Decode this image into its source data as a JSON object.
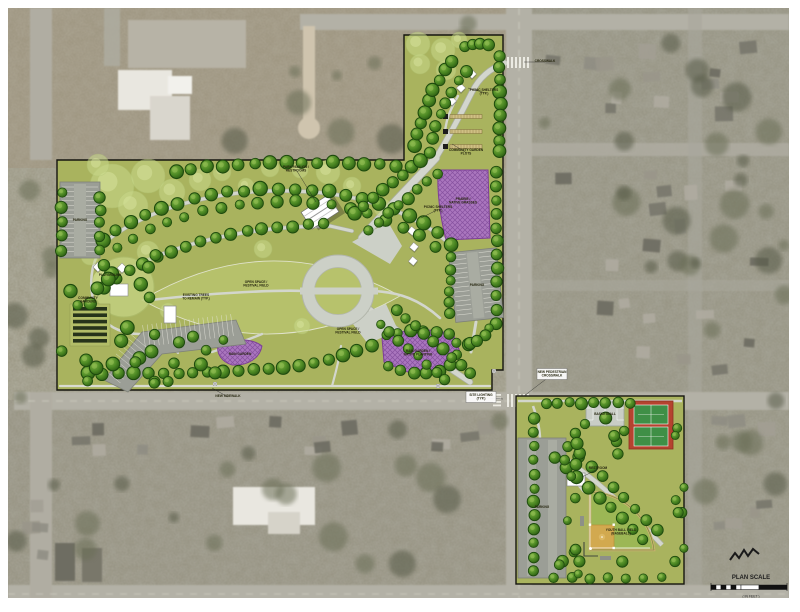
{
  "plan": {
    "title": "Park Master Plan Rendering",
    "scale": {
      "title": "PLAN SCALE",
      "units": "( IN FEET )",
      "note": "1 INCH = 100 FT."
    },
    "colors": {
      "plan_green": "#a9b35e",
      "lawn_green": "#b7c26c",
      "tree_green": "#3f7d21",
      "native_purple": "#a873bd",
      "tennis_red": "#b5432f",
      "court_green": "#3f8f46",
      "infield_tan": "#d2a94f",
      "path_gray": "#d3d6cd"
    },
    "annotations": [
      {
        "text": "PARK PAVILION /\nRESTROOMS",
        "x": 296,
        "y": 168,
        "lx": 316,
        "ly": 202
      },
      {
        "text": "OPEN SPACE /\nFESTIVAL FIELD",
        "x": 256,
        "y": 283
      },
      {
        "text": "OPEN SPACE /\nFESTIVAL FIELD",
        "x": 348,
        "y": 330
      },
      {
        "text": "PICNIC SHELTERS\n(TYP.)",
        "x": 438,
        "y": 208,
        "lx": 421,
        "ly": 218
      },
      {
        "text": "PLAYGROUND",
        "x": 110,
        "y": 276
      },
      {
        "text": "COMMUNITY\nGARDENS",
        "x": 88,
        "y": 299
      },
      {
        "text": "EXISTING TREES\nTO REMAIN (TYP.)",
        "x": 196,
        "y": 296
      },
      {
        "text": "RAIN GARDEN /\nNATIVE PLANTING",
        "x": 418,
        "y": 352
      },
      {
        "text": "RAIN GARDEN",
        "x": 240,
        "y": 355
      },
      {
        "text": "PRAIRIE /\nNATIVE GRASSES",
        "x": 463,
        "y": 200
      },
      {
        "text": "COMMUNITY GARDEN\nPLOTS",
        "x": 466,
        "y": 151,
        "lx": 452,
        "ly": 144
      },
      {
        "text": "PICNIC SHELTERS\n(TYP.)",
        "x": 484,
        "y": 91,
        "lx": 468,
        "ly": 88
      },
      {
        "text": "CROSSWALK",
        "x": 545,
        "y": 62,
        "lx": 524,
        "ly": 62
      },
      {
        "text": "NEW SIDEWALK",
        "x": 228,
        "y": 397,
        "lx": 212,
        "ly": 388
      },
      {
        "text": "SITE LIGHTING\n(TYP.)",
        "x": 481,
        "y": 396,
        "box": true,
        "lx": 503,
        "ly": 399
      },
      {
        "text": "NEW PEDESTRIAN\nCROSSWALK",
        "x": 552,
        "y": 373,
        "box": true,
        "lx": 524,
        "ly": 396
      },
      {
        "text": "PARKING",
        "x": 80,
        "y": 221
      },
      {
        "text": "PARKING",
        "x": 477,
        "y": 286
      },
      {
        "text": "PARKING",
        "x": 542,
        "y": 508
      },
      {
        "text": "BASKETBALL",
        "x": 605,
        "y": 415
      },
      {
        "text": "YOUTH BALL FIELD\n(BASEBALL)",
        "x": 621,
        "y": 531
      },
      {
        "text": "RESTROOM",
        "x": 598,
        "y": 469,
        "lx": 582,
        "ly": 477
      }
    ]
  }
}
